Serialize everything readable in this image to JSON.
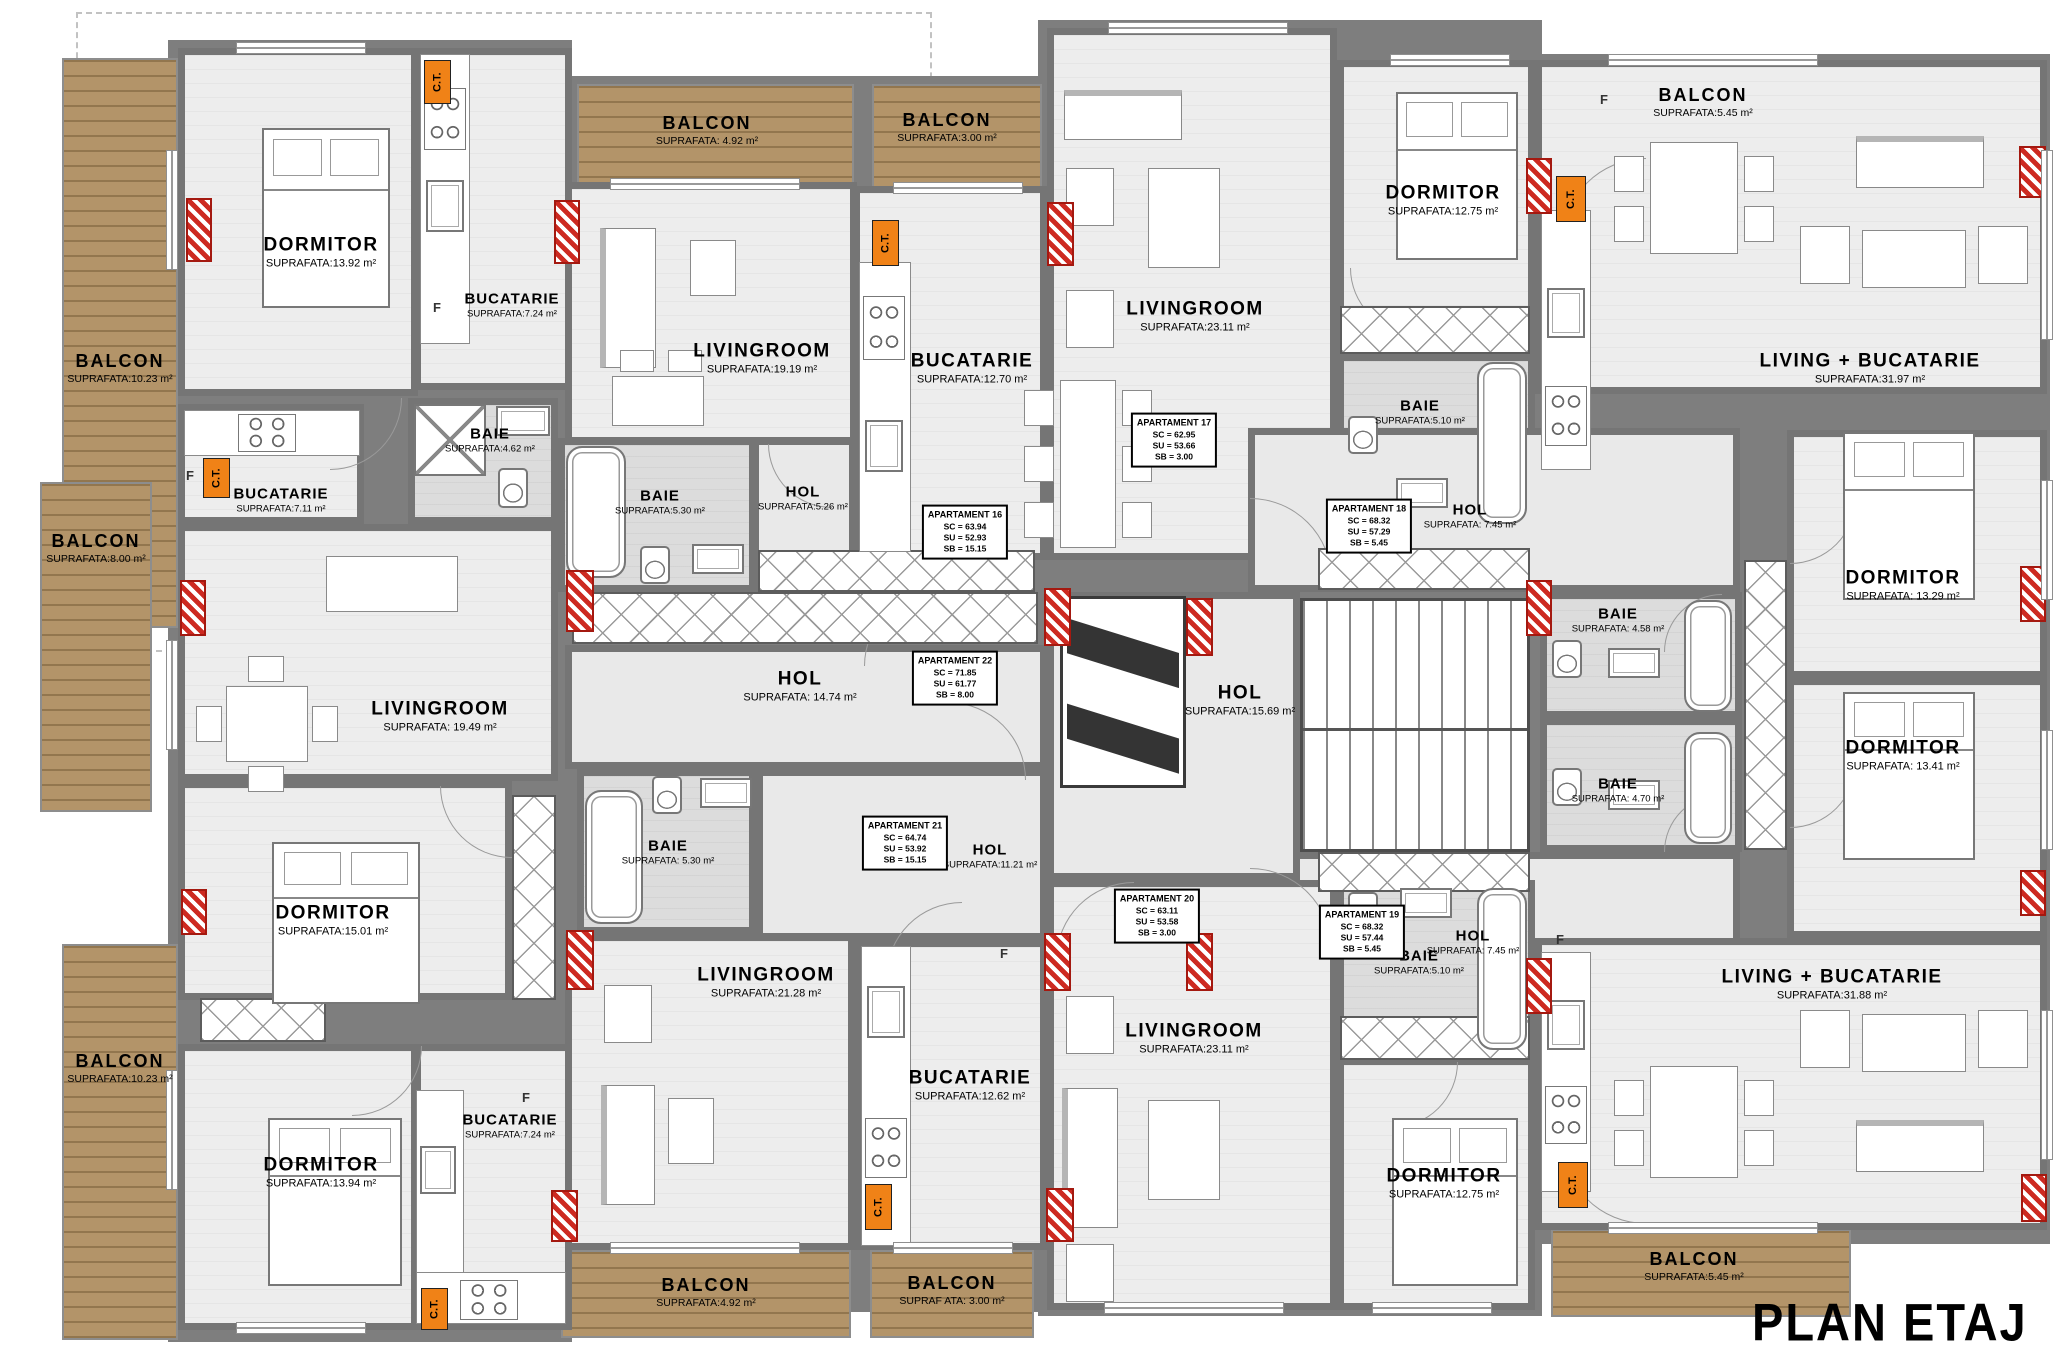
{
  "title": "PLAN ETAJ 3",
  "ct": "C.T.",
  "fridge": "F",
  "colors": {
    "wall": "#7e7e7e",
    "floor": "#ededed",
    "bath_floor": "#dcdcdc",
    "balcony_wood": "#b39469",
    "ct_orange": "#f08217",
    "column_red": "#cd2a21"
  },
  "rooms": {
    "d16": {
      "name": "DORMITOR",
      "area": "SUPRAFATA:13.92 m²"
    },
    "k16": {
      "name": "BUCATARIE",
      "area": "SUPRAFATA:7.24 m²"
    },
    "l16": {
      "name": "LIVINGROOM",
      "area": "SUPRAFATA:19.19 m²"
    },
    "b16": {
      "name": "BAIE",
      "area": "SUPRAFATA:5.30 m²"
    },
    "h16": {
      "name": "HOL",
      "area": "SUPRAFATA:5.26 m²"
    },
    "k17": {
      "name": "BUCATARIE",
      "area": "SUPRAFATA:12.70 m²"
    },
    "l17": {
      "name": "LIVINGROOM",
      "area": "SUPRAFATA:23.11 m²"
    },
    "d17": {
      "name": "DORMITOR",
      "area": "SUPRAFATA:12.75 m²"
    },
    "b17": {
      "name": "BAIE",
      "area": "SUPRAFATA:5.10 m²"
    },
    "lk18": {
      "name": "LIVING + BUCATARIE",
      "area": "SUPRAFATA:31.97 m²"
    },
    "h18": {
      "name": "HOL",
      "area": "SUPRAFATA: 7.45 m²"
    },
    "b18": {
      "name": "BAIE",
      "area": "SUPRAFATA: 4.58 m²"
    },
    "d18": {
      "name": "DORMITOR",
      "area": "SUPRAFATA: 13.29 m²"
    },
    "d19": {
      "name": "DORMITOR",
      "area": "SUPRAFATA: 13.41 m²"
    },
    "b19": {
      "name": "BAIE",
      "area": "SUPRAFATA: 4.70 m²"
    },
    "h19": {
      "name": "HOL",
      "area": "SUPRAFATA: 7.45 m²"
    },
    "lk19": {
      "name": "LIVING + BUCATARIE",
      "area": "SUPRAFATA:31.88 m²"
    },
    "h22": {
      "name": "HOL",
      "area": "SUPRAFATA: 14.74 m²"
    },
    "hc": {
      "name": "HOL",
      "area": "SUPRAFATA:15.69 m²"
    },
    "k22": {
      "name": "BUCATARIE",
      "area": "SUPRAFATA:7.11 m²"
    },
    "b22": {
      "name": "BAIE",
      "area": "SUPRAFATA:4.62 m²"
    },
    "l22": {
      "name": "LIVINGROOM",
      "area": "SUPRAFATA: 19.49 m²"
    },
    "d22": {
      "name": "DORMITOR",
      "area": "SUPRAFATA:15.01 m²"
    },
    "b21": {
      "name": "BAIE",
      "area": "SUPRAFATA: 5.30 m²"
    },
    "h21": {
      "name": "HOL",
      "area": "SUPRAFATA:11.21 m²"
    },
    "l21": {
      "name": "LIVINGROOM",
      "area": "SUPRAFATA:21.28 m²"
    },
    "d21": {
      "name": "DORMITOR",
      "area": "SUPRAFATA:13.94 m²"
    },
    "k21": {
      "name": "BUCATARIE",
      "area": "SUPRAFATA:7.24 m²"
    },
    "k20": {
      "name": "BUCATARIE",
      "area": "SUPRAFATA:12.62 m²"
    },
    "l20": {
      "name": "LIVINGROOM",
      "area": "SUPRAFATA:23.11 m²"
    },
    "b20": {
      "name": "BAIE",
      "area": "SUPRAFATA:5.10 m²"
    },
    "d20": {
      "name": "DORMITOR",
      "area": "SUPRAFATA:12.75 m²"
    }
  },
  "balconies": {
    "topLeft": {
      "name": "BALCON",
      "area": "SUPRAFATA:10.23 m²"
    },
    "midLeft": {
      "name": "BALCON",
      "area": "SUPRAFATA:8.00 m²"
    },
    "bottomLeft": {
      "name": "BALCON",
      "area": "SUPRAFATA:10.23 m²"
    },
    "topA": {
      "name": "BALCON",
      "area": "SUPRAFATA: 4.92 m²"
    },
    "topB": {
      "name": "BALCON",
      "area": "SUPRAFATA:3.00 m²"
    },
    "topRight": {
      "name": "BALCON",
      "area": "SUPRAFATA:5.45 m²"
    },
    "bottomA": {
      "name": "BALCON",
      "area": "SUPRAFATA:4.92 m²"
    },
    "bottomB": {
      "name": "BALCON",
      "area": "SUPRAF ATA: 3.00 m²"
    },
    "bottomRight": {
      "name": "BALCON",
      "area": "SUPRAFATA:5.45 m²"
    }
  },
  "apartments": {
    "a16": {
      "name": "APARTAMENT 16",
      "sc": "SC = 63.94",
      "su": "SU = 52.93",
      "sb": "SB = 15.15"
    },
    "a17": {
      "name": "APARTAMENT 17",
      "sc": "SC = 62.95",
      "su": "SU = 53.66",
      "sb": "SB = 3.00"
    },
    "a18": {
      "name": "APARTAMENT 18",
      "sc": "SC = 68.32",
      "su": "SU = 57.29",
      "sb": "SB = 5.45"
    },
    "a19": {
      "name": "APARTAMENT 19",
      "sc": "SC = 68.32",
      "su": "SU = 57.44",
      "sb": "SB = 5.45"
    },
    "a20": {
      "name": "APARTAMENT 20",
      "sc": "SC = 63.11",
      "su": "SU = 53.58",
      "sb": "SB = 3.00"
    },
    "a21": {
      "name": "APARTAMENT 21",
      "sc": "SC = 64.74",
      "su": "SU = 53.92",
      "sb": "SB = 15.15"
    },
    "a22": {
      "name": "APARTAMENT 22",
      "sc": "SC = 71.85",
      "su": "SU = 61.77",
      "sb": "SB = 8.00"
    }
  }
}
